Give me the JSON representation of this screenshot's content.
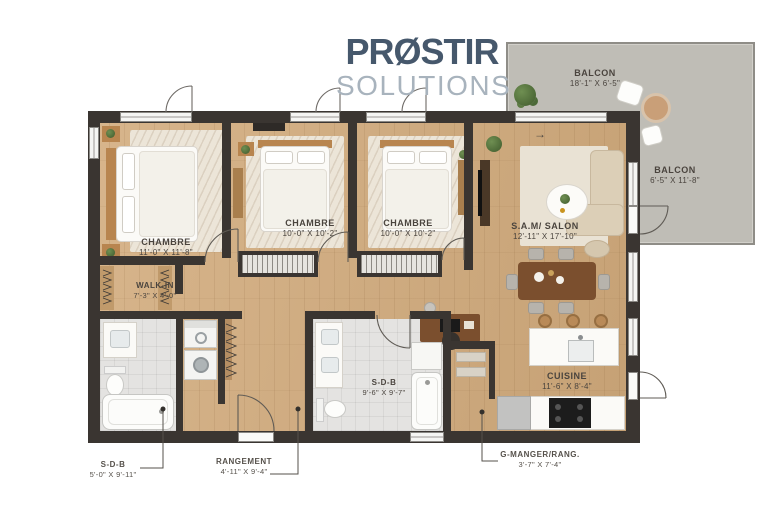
{
  "logo": {
    "wordmark": "PRØSTIR",
    "subtitle": "SOLUTIONS"
  },
  "balconies": [
    {
      "name": "BALCON",
      "dims": "18'-1\" X 6'-5\""
    },
    {
      "name": "BALCON",
      "dims": "6'-5\" X 11'-8\""
    }
  ],
  "rooms": [
    {
      "name": "CHAMBRE",
      "dims": "11'-0\" X 11'-8\""
    },
    {
      "name": "CHAMBRE",
      "dims": "10'-0\" X 10'-2\""
    },
    {
      "name": "CHAMBRE",
      "dims": "10'-0\" X 10'-2\""
    },
    {
      "name": "S.A.M/ SALON",
      "dims": "12'-11\" X 17'-10\""
    },
    {
      "name": "WALK-IN",
      "dims": "7'-3\" X 4'-0\""
    },
    {
      "name": "S-D-B",
      "dims": "9'-6\" X 9'-7\""
    },
    {
      "name": "CUISINE",
      "dims": "11'-6\" X 8'-4\""
    }
  ],
  "callouts": [
    {
      "name": "S-D-B",
      "dims": "5'-0\" X 9'-11\""
    },
    {
      "name": "RANGEMENT",
      "dims": "4'-11\" X 9'-4\""
    },
    {
      "name": "G-MANGER/RANG.",
      "dims": "3'-7\" X 7'-4\""
    }
  ],
  "icons": {
    "north_arrow": "→"
  },
  "colors": {
    "wall": "#3a3531",
    "wood": "#d2ab7c",
    "balcony": "#bfbdb6",
    "tile": "#e4e3e1",
    "logo1": "#46586c",
    "logo2": "#a8b3bd",
    "label": "#4a443e"
  }
}
